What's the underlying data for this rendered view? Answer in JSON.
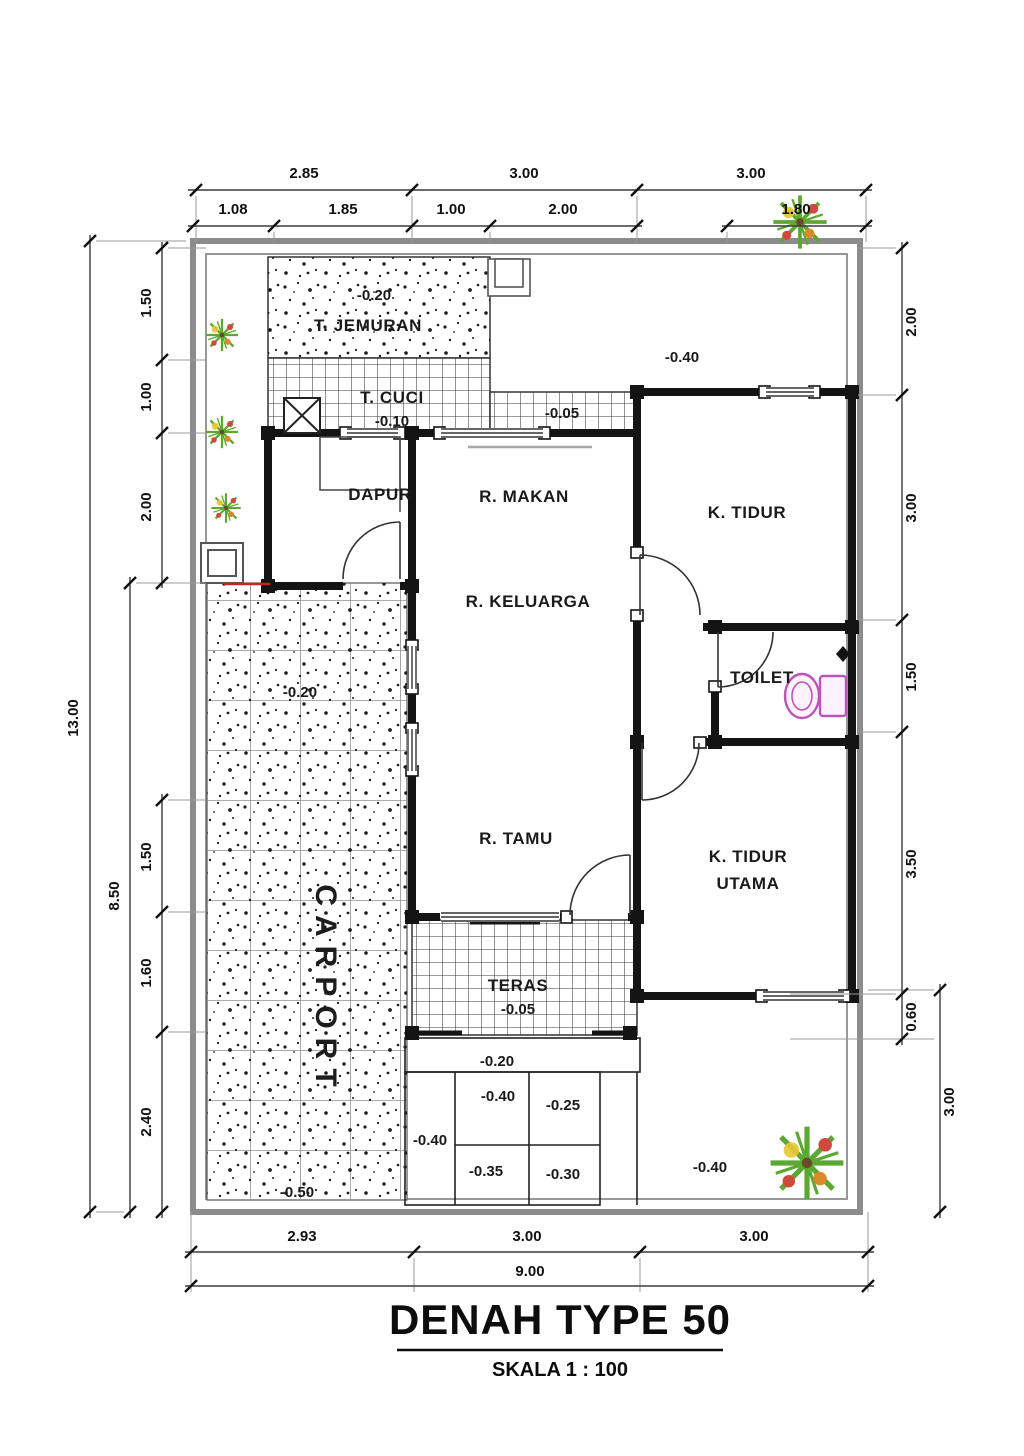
{
  "title": "DENAH TYPE 50",
  "subtitle": "SKALA 1 : 100",
  "rooms": {
    "jemuran": "T. JEMURAN",
    "jemuran_elev": "-0.20",
    "cuci": "T. CUCI",
    "cuci_elev": "-0.10",
    "dapur": "DAPUR",
    "makan": "R. MAKAN",
    "tidur": "K. TIDUR",
    "keluarga": "R. KELUARGA",
    "toilet": "TOILET",
    "tamu": "R. TAMU",
    "tidur_utama_line1": "K. TIDUR",
    "tidur_utama_line2": "UTAMA",
    "teras": "TERAS",
    "teras_elev": "-0.05",
    "carport": "CARPORT",
    "carport_elev_top": "-0.20",
    "carport_elev_bottom": "-0.50",
    "hall_elev": "-0.05",
    "yard_top_elev": "-0.40",
    "yard_bottom_elev": "-0.40",
    "band_elev": "-0.20",
    "step_a": "-0.40",
    "step_b": "-0.25",
    "step_left": "-0.40",
    "step_c": "-0.35",
    "step_d": "-0.30"
  },
  "dims": {
    "top1": [
      "2.85",
      "3.00",
      "3.00"
    ],
    "top2": [
      "1.08",
      "1.85",
      "1.00",
      "2.00",
      "1.80"
    ],
    "bottom1": [
      "2.93",
      "3.00",
      "3.00"
    ],
    "bottom_total": "9.00",
    "left_total": "13.00",
    "left_mid": "8.50",
    "left_upper": [
      "1.50",
      "1.00",
      "2.00"
    ],
    "left_lower": [
      "1.50",
      "1.60",
      "2.40"
    ],
    "right": [
      "2.00",
      "3.00",
      "1.50",
      "3.50",
      "0.60"
    ],
    "right_outer": "3.00"
  },
  "colors": {
    "wall": "#141414",
    "boundary": "#8c8c8c",
    "toilet_pink": "#bb55bb",
    "plant_green": "#5da832",
    "accent_red": "#cc2222"
  }
}
